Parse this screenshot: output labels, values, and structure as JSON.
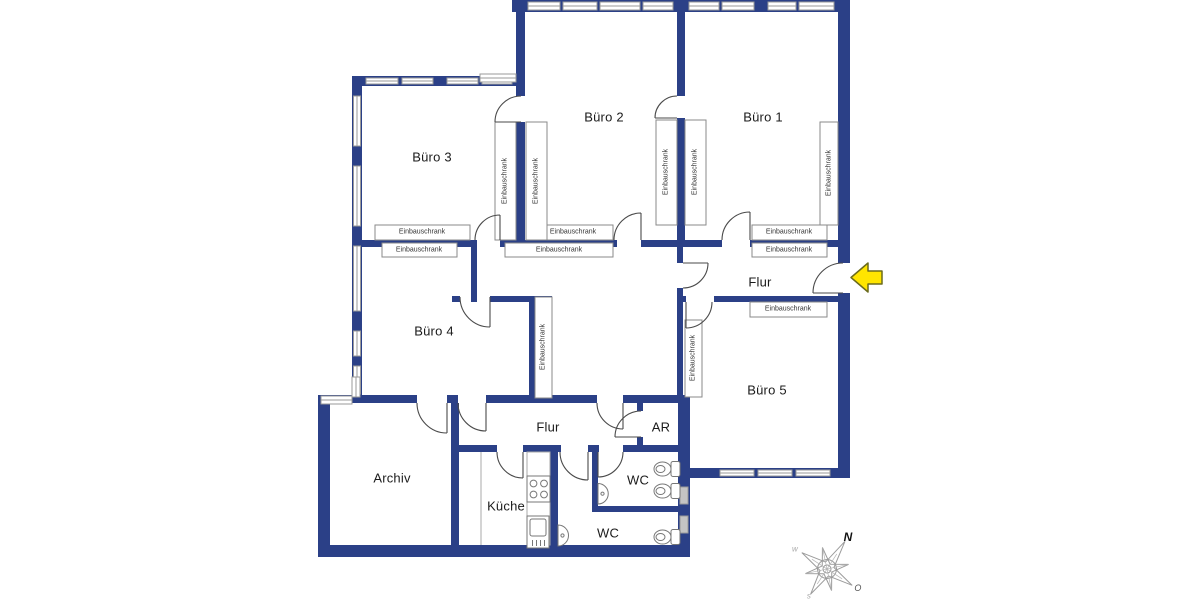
{
  "plan": {
    "rooms": {
      "buero1": "Büro 1",
      "buero2": "Büro 2",
      "buero3": "Büro 3",
      "buero4": "Büro 4",
      "buero5": "Büro 5",
      "flur_main": "Flur",
      "flur_lower": "Flur",
      "ar": "AR",
      "archiv": "Archiv",
      "kueche": "Küche",
      "wc_upper": "WC",
      "wc_lower": "WC"
    },
    "closet_label": "Einbauschrank",
    "compass": {
      "north": "N",
      "east": "O",
      "south": "s",
      "west": "w"
    },
    "colors": {
      "wall": "#2b4087",
      "window_frame": "#9a9a9a",
      "door_arc": "#4a4a4a",
      "fixture": "#777777",
      "arrow_fill": "#ffe500",
      "arrow_stroke": "#6b6b1c"
    }
  }
}
